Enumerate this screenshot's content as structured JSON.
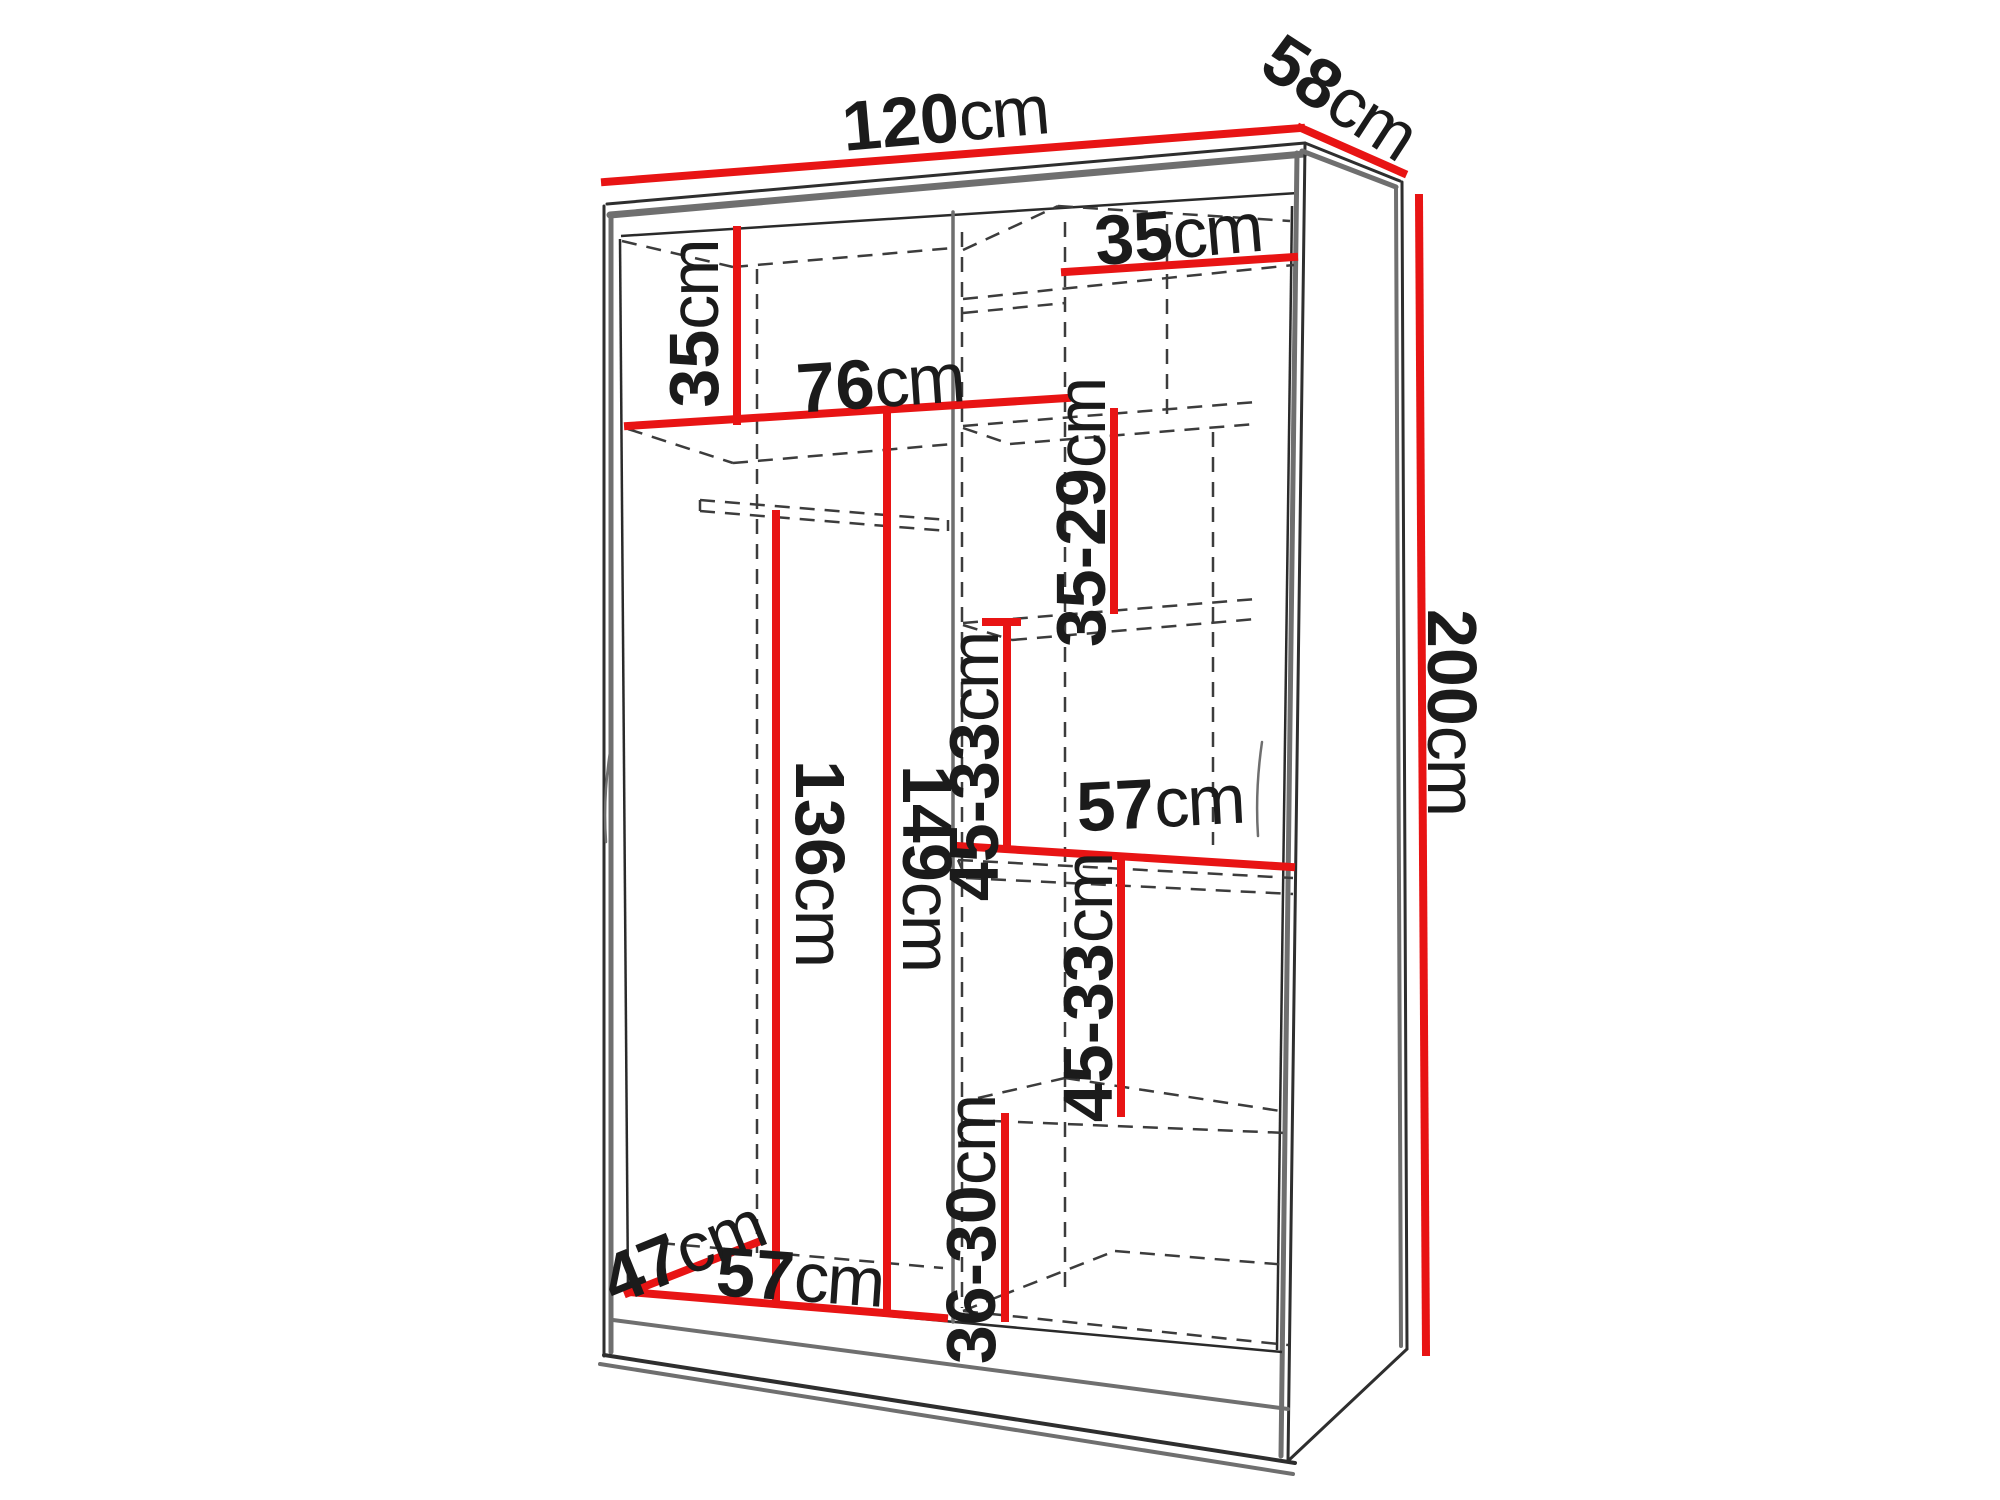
{
  "diagram": {
    "type": "furniture-dimension-diagram",
    "subject": "wardrobe interior dimensions",
    "unit": "cm",
    "dimension_color": "#e81414",
    "outline_color": "#2e2e2e",
    "labels": {
      "top_width": {
        "value": "120",
        "unit": "cm"
      },
      "top_depth": {
        "value": "58",
        "unit": "cm"
      },
      "height": {
        "value": "200",
        "unit": "cm"
      },
      "left_top_cell_height": {
        "value": "35",
        "unit": "cm"
      },
      "left_shelf_width": {
        "value": "76",
        "unit": "cm"
      },
      "right_top_cell_width": {
        "value": "35",
        "unit": "cm"
      },
      "right_cell2_height": {
        "value": "35-29",
        "unit": "cm"
      },
      "right_cell3_height": {
        "value": "45-33",
        "unit": "cm"
      },
      "right_mid_shelf_width": {
        "value": "57",
        "unit": "cm"
      },
      "right_cell4_height": {
        "value": "45-33",
        "unit": "cm"
      },
      "right_bottom_cell_height": {
        "value": "36-30",
        "unit": "cm"
      },
      "hanging_rod_height": {
        "value": "136",
        "unit": "cm"
      },
      "left_interior_height": {
        "value": "149",
        "unit": "cm"
      },
      "bottom_depth": {
        "value": "47",
        "unit": "cm"
      },
      "bottom_width": {
        "value": "57",
        "unit": "cm"
      }
    }
  }
}
